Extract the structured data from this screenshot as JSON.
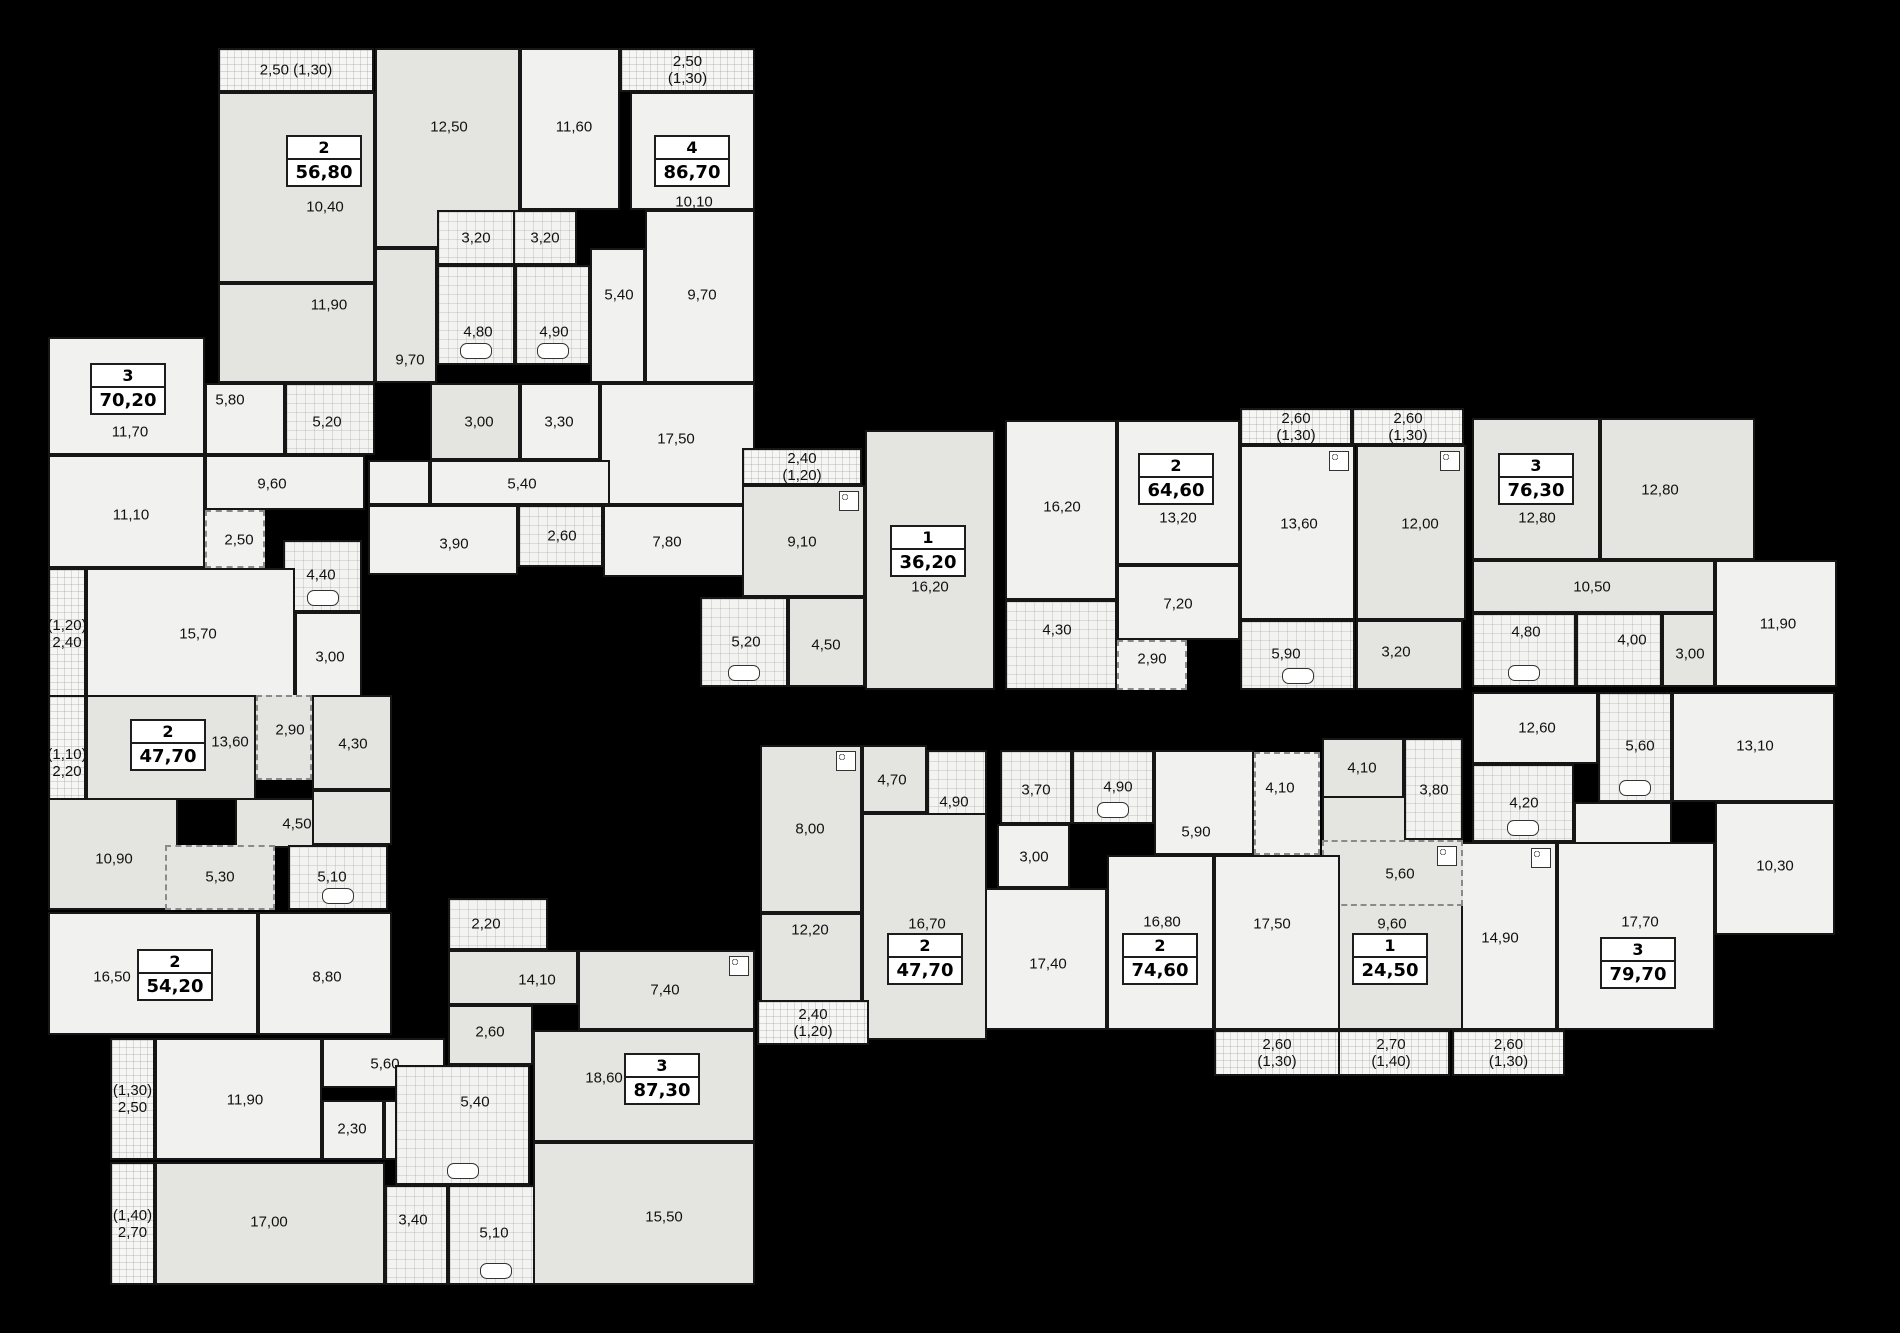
{
  "canvas": {
    "width": 1900,
    "height": 1333,
    "background": "#000000"
  },
  "colors": {
    "room_light": "#f1f1ef",
    "room_gray": "#e4e4e1",
    "wall": "#161616",
    "label": "#111111",
    "idbox_bg": "#ffffff"
  },
  "apartments": [
    {
      "rooms_count": "2",
      "area": "56,80",
      "cx": 324,
      "cy": 160
    },
    {
      "rooms_count": "4",
      "area": "86,70",
      "cx": 692,
      "cy": 160
    },
    {
      "rooms_count": "3",
      "area": "70,20",
      "cx": 128,
      "cy": 388
    },
    {
      "rooms_count": "1",
      "area": "36,20",
      "cx": 928,
      "cy": 550
    },
    {
      "rooms_count": "2",
      "area": "64,60",
      "cx": 1176,
      "cy": 478
    },
    {
      "rooms_count": "3",
      "area": "76,30",
      "cx": 1536,
      "cy": 478
    },
    {
      "rooms_count": "2",
      "area": "47,70",
      "cx": 168,
      "cy": 744
    },
    {
      "rooms_count": "2",
      "area": "54,20",
      "cx": 175,
      "cy": 974
    },
    {
      "rooms_count": "3",
      "area": "87,30",
      "cx": 662,
      "cy": 1078
    },
    {
      "rooms_count": "2",
      "area": "47,70",
      "cx": 925,
      "cy": 958
    },
    {
      "rooms_count": "2",
      "area": "74,60",
      "cx": 1160,
      "cy": 958
    },
    {
      "rooms_count": "1",
      "area": "24,50",
      "cx": 1390,
      "cy": 958
    },
    {
      "rooms_count": "3",
      "area": "79,70",
      "cx": 1638,
      "cy": 962
    }
  ],
  "rooms": [
    {
      "label": "2,50 (1,30)",
      "x": 218,
      "y": 48,
      "w": 156,
      "h": 44,
      "k": "bal"
    },
    {
      "label": "10,40",
      "x": 218,
      "y": 92,
      "w": 157,
      "h": 191,
      "k": "r",
      "s": "g",
      "lx": 323,
      "ly": 205
    },
    {
      "label": "11,90",
      "x": 218,
      "y": 283,
      "w": 157,
      "h": 100,
      "k": "r",
      "s": "g",
      "lx": 327,
      "ly": 303
    },
    {
      "label": "12,50",
      "x": 375,
      "y": 48,
      "w": 145,
      "h": 200,
      "k": "r",
      "s": "g",
      "lx": 447,
      "ly": 125
    },
    {
      "label": "9,70",
      "x": 375,
      "y": 248,
      "w": 62,
      "h": 135,
      "k": "r",
      "s": "g",
      "lx": 408,
      "ly": 358
    },
    {
      "label": "3,20",
      "x": 437,
      "y": 210,
      "w": 78,
      "h": 55,
      "k": "wet"
    },
    {
      "label": "3,20",
      "x": 513,
      "y": 210,
      "w": 64,
      "h": 55,
      "k": "wet"
    },
    {
      "label": "4,80",
      "x": 437,
      "y": 265,
      "w": 78,
      "h": 100,
      "k": "wet",
      "lx": 476,
      "ly": 330,
      "fix": "tub"
    },
    {
      "label": "4,90",
      "x": 515,
      "y": 265,
      "w": 75,
      "h": 100,
      "k": "wet",
      "lx": 552,
      "ly": 330,
      "fix": "tub"
    },
    {
      "label": "5,40",
      "x": 590,
      "y": 248,
      "w": 55,
      "h": 135,
      "k": "r",
      "lx": 617,
      "ly": 293
    },
    {
      "label": "9,70",
      "x": 645,
      "y": 210,
      "w": 110,
      "h": 173,
      "k": "r",
      "lx": 700,
      "ly": 293
    },
    {
      "label": "11,60",
      "x": 520,
      "y": 48,
      "w": 100,
      "h": 162,
      "k": "r",
      "lx": 572,
      "ly": 125
    },
    {
      "label": "2,50 (1,30)",
      "x": 620,
      "y": 48,
      "w": 135,
      "h": 44,
      "k": "bal"
    },
    {
      "label": "10,10",
      "x": 630,
      "y": 92,
      "w": 125,
      "h": 118,
      "k": "r",
      "lx": 692,
      "ly": 200
    },
    {
      "label": "3,00",
      "x": 430,
      "y": 383,
      "w": 90,
      "h": 77,
      "k": "r",
      "s": "g",
      "lx": 477,
      "ly": 420
    },
    {
      "label": "3,30",
      "x": 520,
      "y": 383,
      "w": 80,
      "h": 77,
      "k": "r",
      "lx": 557,
      "ly": 420
    },
    {
      "label": "17,50",
      "x": 600,
      "y": 383,
      "w": 155,
      "h": 122,
      "k": "r",
      "lx": 674,
      "ly": 437
    },
    {
      "label": "5,40",
      "x": 430,
      "y": 460,
      "w": 180,
      "h": 45,
      "k": "r",
      "lx": 520,
      "ly": 482
    },
    {
      "label": "3,90",
      "x": 368,
      "y": 505,
      "w": 150,
      "h": 70,
      "k": "r",
      "lx": 452,
      "ly": 542
    },
    {
      "label": "2,60",
      "x": 518,
      "y": 505,
      "w": 85,
      "h": 62,
      "k": "wet",
      "lx": 560,
      "ly": 534
    },
    {
      "label": "7,80",
      "x": 603,
      "y": 505,
      "w": 152,
      "h": 72,
      "k": "r",
      "lx": 665,
      "ly": 540
    },
    {
      "label": "",
      "x": 368,
      "y": 460,
      "w": 62,
      "h": 45,
      "k": "r"
    },
    {
      "label": "11,70",
      "x": 48,
      "y": 337,
      "w": 157,
      "h": 118,
      "k": "r",
      "lx": 128,
      "ly": 430
    },
    {
      "label": "5,80",
      "x": 205,
      "y": 383,
      "w": 80,
      "h": 72,
      "k": "r",
      "lx": 228,
      "ly": 398
    },
    {
      "label": "5,20",
      "x": 285,
      "y": 383,
      "w": 90,
      "h": 72,
      "k": "wet",
      "lx": 325,
      "ly": 420
    },
    {
      "label": "9,60",
      "x": 205,
      "y": 455,
      "w": 160,
      "h": 55,
      "k": "r",
      "lx": 270,
      "ly": 482
    },
    {
      "label": "11,10",
      "x": 48,
      "y": 455,
      "w": 157,
      "h": 113,
      "k": "r",
      "lx": 129,
      "ly": 513
    },
    {
      "label": "2,50",
      "x": 205,
      "y": 510,
      "w": 60,
      "h": 58,
      "k": "zone",
      "lx": 237,
      "ly": 538
    },
    {
      "label": "4,40",
      "x": 283,
      "y": 540,
      "w": 79,
      "h": 72,
      "k": "wet",
      "lx": 319,
      "ly": 573,
      "fix": "tub"
    },
    {
      "label": "15,70",
      "x": 86,
      "y": 568,
      "w": 209,
      "h": 132,
      "k": "r",
      "lx": 196,
      "ly": 632
    },
    {
      "label": "(1,20)\n2,40",
      "x": 48,
      "y": 568,
      "w": 38,
      "h": 132,
      "k": "bal"
    },
    {
      "label": "3,00",
      "x": 295,
      "y": 612,
      "w": 67,
      "h": 88,
      "k": "r",
      "lx": 328,
      "ly": 655
    },
    {
      "label": "(1,10)\n2,20",
      "x": 48,
      "y": 695,
      "w": 38,
      "h": 135,
      "k": "bal"
    },
    {
      "label": "13,60",
      "x": 86,
      "y": 695,
      "w": 170,
      "h": 105,
      "k": "r",
      "s": "g",
      "lx": 228,
      "ly": 740
    },
    {
      "label": "2,90",
      "x": 256,
      "y": 695,
      "w": 56,
      "h": 85,
      "k": "zone",
      "s": "g",
      "lx": 288,
      "ly": 728
    },
    {
      "label": "4,30",
      "x": 312,
      "y": 695,
      "w": 80,
      "h": 95,
      "k": "r",
      "s": "g",
      "lx": 351,
      "ly": 742
    },
    {
      "label": "4,50",
      "x": 235,
      "y": 798,
      "w": 130,
      "h": 50,
      "k": "r",
      "s": "g",
      "lx": 295,
      "ly": 822
    },
    {
      "label": "10,90",
      "x": 48,
      "y": 798,
      "w": 130,
      "h": 112,
      "k": "r",
      "s": "g",
      "lx": 112,
      "ly": 857
    },
    {
      "label": "5,30",
      "x": 165,
      "y": 845,
      "w": 110,
      "h": 65,
      "k": "zone",
      "s": "g",
      "lx": 218,
      "ly": 875
    },
    {
      "label": "5,10",
      "x": 288,
      "y": 845,
      "w": 100,
      "h": 65,
      "k": "wet",
      "lx": 330,
      "ly": 875,
      "fix": "tub"
    },
    {
      "label": "",
      "x": 312,
      "y": 790,
      "w": 80,
      "h": 55,
      "k": "r",
      "s": "g"
    },
    {
      "label": "16,50",
      "x": 48,
      "y": 912,
      "w": 210,
      "h": 123,
      "k": "r",
      "lx": 110,
      "ly": 975
    },
    {
      "label": "8,80",
      "x": 258,
      "y": 912,
      "w": 134,
      "h": 123,
      "k": "r",
      "lx": 325,
      "ly": 975
    },
    {
      "label": "(1,30)\n2,50",
      "x": 110,
      "y": 1038,
      "w": 45,
      "h": 122,
      "k": "bal"
    },
    {
      "label": "11,90",
      "x": 155,
      "y": 1038,
      "w": 167,
      "h": 122,
      "k": "r",
      "lx": 243,
      "ly": 1098
    },
    {
      "label": "5,60",
      "x": 322,
      "y": 1038,
      "w": 123,
      "h": 50,
      "k": "r",
      "lx": 383,
      "ly": 1062
    },
    {
      "label": "2,30",
      "x": 322,
      "y": 1100,
      "w": 62,
      "h": 60,
      "k": "r",
      "lx": 350,
      "ly": 1127
    },
    {
      "label": "2,40",
      "x": 384,
      "y": 1100,
      "w": 62,
      "h": 60,
      "k": "r",
      "lx": 413,
      "ly": 1127
    },
    {
      "label": "(1,40)\n2,70",
      "x": 110,
      "y": 1162,
      "w": 45,
      "h": 123,
      "k": "bal"
    },
    {
      "label": "17,00",
      "x": 155,
      "y": 1162,
      "w": 230,
      "h": 123,
      "k": "r",
      "s": "g",
      "lx": 267,
      "ly": 1220
    },
    {
      "label": "3,40",
      "x": 385,
      "y": 1185,
      "w": 63,
      "h": 100,
      "k": "wet",
      "lx": 411,
      "ly": 1218
    },
    {
      "label": "5,10",
      "x": 448,
      "y": 1185,
      "w": 95,
      "h": 100,
      "k": "wet",
      "lx": 492,
      "ly": 1231,
      "fix": "tub"
    },
    {
      "label": "2,20",
      "x": 448,
      "y": 898,
      "w": 100,
      "h": 52,
      "k": "wet",
      "lx": 484,
      "ly": 922
    },
    {
      "label": "14,10",
      "x": 448,
      "y": 950,
      "w": 130,
      "h": 55,
      "k": "r",
      "s": "g",
      "lx": 535,
      "ly": 978
    },
    {
      "label": "7,40",
      "x": 578,
      "y": 950,
      "w": 177,
      "h": 80,
      "k": "r",
      "s": "g",
      "lx": 663,
      "ly": 988,
      "fix": "stove"
    },
    {
      "label": "2,60",
      "x": 448,
      "y": 1005,
      "w": 85,
      "h": 60,
      "k": "r",
      "s": "g",
      "lx": 488,
      "ly": 1030
    },
    {
      "label": "5,40",
      "x": 395,
      "y": 1065,
      "w": 135,
      "h": 120,
      "k": "wet",
      "lx": 473,
      "ly": 1100,
      "fix": "tub"
    },
    {
      "label": "18,60",
      "x": 533,
      "y": 1030,
      "w": 222,
      "h": 112,
      "k": "r",
      "s": "g",
      "lx": 602,
      "ly": 1076
    },
    {
      "label": "15,50",
      "x": 533,
      "y": 1142,
      "w": 222,
      "h": 143,
      "k": "r",
      "s": "g",
      "lx": 662,
      "ly": 1215
    },
    {
      "label": "2,40 (1,20)",
      "x": 742,
      "y": 448,
      "w": 120,
      "h": 37,
      "k": "bal"
    },
    {
      "label": "9,10",
      "x": 742,
      "y": 485,
      "w": 123,
      "h": 112,
      "k": "r",
      "s": "g",
      "lx": 800,
      "ly": 540,
      "fix": "stove"
    },
    {
      "label": "16,20",
      "x": 865,
      "y": 430,
      "w": 130,
      "h": 260,
      "k": "r",
      "s": "g",
      "lx": 928,
      "ly": 585
    },
    {
      "label": "5,20",
      "x": 700,
      "y": 597,
      "w": 88,
      "h": 90,
      "k": "wet",
      "lx": 744,
      "ly": 640,
      "fix": "tub"
    },
    {
      "label": "4,50",
      "x": 788,
      "y": 597,
      "w": 77,
      "h": 90,
      "k": "r",
      "s": "g",
      "lx": 824,
      "ly": 643
    },
    {
      "label": "16,20",
      "x": 1005,
      "y": 420,
      "w": 112,
      "h": 180,
      "k": "r",
      "lx": 1060,
      "ly": 505
    },
    {
      "label": "13,20",
      "x": 1117,
      "y": 420,
      "w": 123,
      "h": 145,
      "k": "r",
      "lx": 1176,
      "ly": 516
    },
    {
      "label": "2,60 (1,30)",
      "x": 1240,
      "y": 408,
      "w": 112,
      "h": 37,
      "k": "bal"
    },
    {
      "label": "13,60",
      "x": 1240,
      "y": 445,
      "w": 115,
      "h": 175,
      "k": "r",
      "lx": 1297,
      "ly": 522,
      "fix": "stove"
    },
    {
      "label": "7,20",
      "x": 1117,
      "y": 565,
      "w": 123,
      "h": 75,
      "k": "r",
      "lx": 1176,
      "ly": 602
    },
    {
      "label": "4,30",
      "x": 1005,
      "y": 600,
      "w": 112,
      "h": 90,
      "k": "wet",
      "lx": 1055,
      "ly": 628
    },
    {
      "label": "2,90",
      "x": 1117,
      "y": 640,
      "w": 70,
      "h": 50,
      "k": "zone",
      "lx": 1150,
      "ly": 657
    },
    {
      "label": "5,90",
      "x": 1240,
      "y": 620,
      "w": 115,
      "h": 70,
      "k": "wet",
      "lx": 1284,
      "ly": 652,
      "fix": "tub"
    },
    {
      "label": "2,60 (1,30)",
      "x": 1352,
      "y": 408,
      "w": 112,
      "h": 37,
      "k": "bal"
    },
    {
      "label": "12,00",
      "x": 1356,
      "y": 445,
      "w": 110,
      "h": 175,
      "k": "r",
      "s": "g",
      "lx": 1418,
      "ly": 522,
      "fix": "stove"
    },
    {
      "label": "3,20",
      "x": 1356,
      "y": 620,
      "w": 107,
      "h": 70,
      "k": "r",
      "s": "g",
      "lx": 1394,
      "ly": 650
    },
    {
      "label": "12,80",
      "x": 1472,
      "y": 418,
      "w": 128,
      "h": 142,
      "k": "r",
      "s": "g",
      "lx": 1535,
      "ly": 516
    },
    {
      "label": "12,80",
      "x": 1600,
      "y": 418,
      "w": 155,
      "h": 142,
      "k": "r",
      "s": "g",
      "lx": 1658,
      "ly": 488
    },
    {
      "label": "10,50",
      "x": 1472,
      "y": 560,
      "w": 243,
      "h": 53,
      "k": "r",
      "s": "g",
      "lx": 1590,
      "ly": 585
    },
    {
      "label": "4,80",
      "x": 1472,
      "y": 613,
      "w": 104,
      "h": 74,
      "k": "wet",
      "lx": 1524,
      "ly": 630,
      "fix": "tub"
    },
    {
      "label": "4,00",
      "x": 1576,
      "y": 613,
      "w": 86,
      "h": 74,
      "k": "wet",
      "lx": 1630,
      "ly": 638
    },
    {
      "label": "3,00",
      "x": 1662,
      "y": 613,
      "w": 53,
      "h": 74,
      "k": "r",
      "s": "g",
      "lx": 1688,
      "ly": 652
    },
    {
      "label": "11,90",
      "x": 1715,
      "y": 560,
      "w": 122,
      "h": 127,
      "k": "r",
      "lx": 1776,
      "ly": 622
    },
    {
      "label": "12,60",
      "x": 1472,
      "y": 692,
      "w": 126,
      "h": 72,
      "k": "r",
      "lx": 1535,
      "ly": 726
    },
    {
      "label": "5,60",
      "x": 1598,
      "y": 692,
      "w": 74,
      "h": 110,
      "k": "wet",
      "lx": 1638,
      "ly": 744,
      "fix": "tub"
    },
    {
      "label": "13,10",
      "x": 1672,
      "y": 692,
      "w": 163,
      "h": 110,
      "k": "r",
      "lx": 1753,
      "ly": 744
    },
    {
      "label": "4,20",
      "x": 1472,
      "y": 764,
      "w": 102,
      "h": 78,
      "k": "wet",
      "lx": 1522,
      "ly": 801,
      "fix": "tub"
    },
    {
      "label": "10,30",
      "x": 1715,
      "y": 802,
      "w": 120,
      "h": 133,
      "k": "r",
      "lx": 1773,
      "ly": 864
    },
    {
      "label": "14,90",
      "x": 1440,
      "y": 842,
      "w": 117,
      "h": 188,
      "k": "r",
      "lx": 1498,
      "ly": 936,
      "fix": "stove"
    },
    {
      "label": "17,70",
      "x": 1557,
      "y": 842,
      "w": 158,
      "h": 188,
      "k": "r",
      "lx": 1638,
      "ly": 920
    },
    {
      "label": "",
      "x": 1574,
      "y": 802,
      "w": 98,
      "h": 42,
      "k": "r"
    },
    {
      "label": "2,60 (1,30)",
      "x": 1452,
      "y": 1030,
      "w": 113,
      "h": 46,
      "k": "bal"
    },
    {
      "label": "9,60",
      "x": 1322,
      "y": 738,
      "w": 141,
      "h": 292,
      "k": "r",
      "s": "g",
      "lx": 1390,
      "ly": 922
    },
    {
      "label": "4,10",
      "x": 1322,
      "y": 738,
      "w": 82,
      "h": 60,
      "k": "r",
      "s": "g",
      "lx": 1360,
      "ly": 766
    },
    {
      "label": "3,80",
      "x": 1404,
      "y": 738,
      "w": 59,
      "h": 102,
      "k": "wet",
      "lx": 1432,
      "ly": 788
    },
    {
      "label": "5,60",
      "x": 1322,
      "y": 840,
      "w": 141,
      "h": 66,
      "k": "zone",
      "s": "g",
      "lx": 1398,
      "ly": 872,
      "fix": "stove"
    },
    {
      "label": "2,70 (1,40)",
      "x": 1332,
      "y": 1030,
      "w": 118,
      "h": 46,
      "k": "bal"
    },
    {
      "label": "3,70",
      "x": 1000,
      "y": 750,
      "w": 72,
      "h": 74,
      "k": "wet",
      "lx": 1034,
      "ly": 788
    },
    {
      "label": "4,90",
      "x": 1072,
      "y": 750,
      "w": 82,
      "h": 74,
      "k": "wet",
      "lx": 1116,
      "ly": 785,
      "fix": "tub"
    },
    {
      "label": "5,90",
      "x": 1154,
      "y": 750,
      "w": 100,
      "h": 105,
      "k": "r",
      "lx": 1194,
      "ly": 830
    },
    {
      "label": "4,10",
      "x": 1254,
      "y": 752,
      "w": 66,
      "h": 103,
      "k": "zone",
      "lx": 1278,
      "ly": 786
    },
    {
      "label": "3,00",
      "x": 997,
      "y": 824,
      "w": 73,
      "h": 64,
      "k": "r",
      "lx": 1032,
      "ly": 855
    },
    {
      "label": "17,40",
      "x": 985,
      "y": 888,
      "w": 122,
      "h": 142,
      "k": "r",
      "lx": 1046,
      "ly": 962
    },
    {
      "label": "16,80",
      "x": 1107,
      "y": 855,
      "w": 107,
      "h": 175,
      "k": "r",
      "lx": 1160,
      "ly": 920
    },
    {
      "label": "17,50",
      "x": 1214,
      "y": 855,
      "w": 126,
      "h": 175,
      "k": "r",
      "lx": 1270,
      "ly": 922
    },
    {
      "label": "2,60 (1,30)",
      "x": 1214,
      "y": 1030,
      "w": 126,
      "h": 46,
      "k": "bal"
    },
    {
      "label": "8,00",
      "x": 760,
      "y": 745,
      "w": 102,
      "h": 168,
      "k": "r",
      "s": "g",
      "lx": 808,
      "ly": 827,
      "fix": "stove"
    },
    {
      "label": "4,70",
      "x": 862,
      "y": 745,
      "w": 65,
      "h": 68,
      "k": "r",
      "s": "g",
      "lx": 890,
      "ly": 778
    },
    {
      "label": "4,90",
      "x": 927,
      "y": 750,
      "w": 60,
      "h": 100,
      "k": "wet",
      "lx": 952,
      "ly": 800,
      "fix": "tub"
    },
    {
      "label": "16,70",
      "x": 862,
      "y": 813,
      "w": 125,
      "h": 227,
      "k": "r",
      "s": "g",
      "lx": 925,
      "ly": 922
    },
    {
      "label": "12,20",
      "x": 760,
      "y": 913,
      "w": 102,
      "h": 127,
      "k": "r",
      "s": "g",
      "lx": 808,
      "ly": 928
    },
    {
      "label": "2,40 (1,20)",
      "x": 757,
      "y": 1000,
      "w": 112,
      "h": 45,
      "k": "bal"
    }
  ]
}
